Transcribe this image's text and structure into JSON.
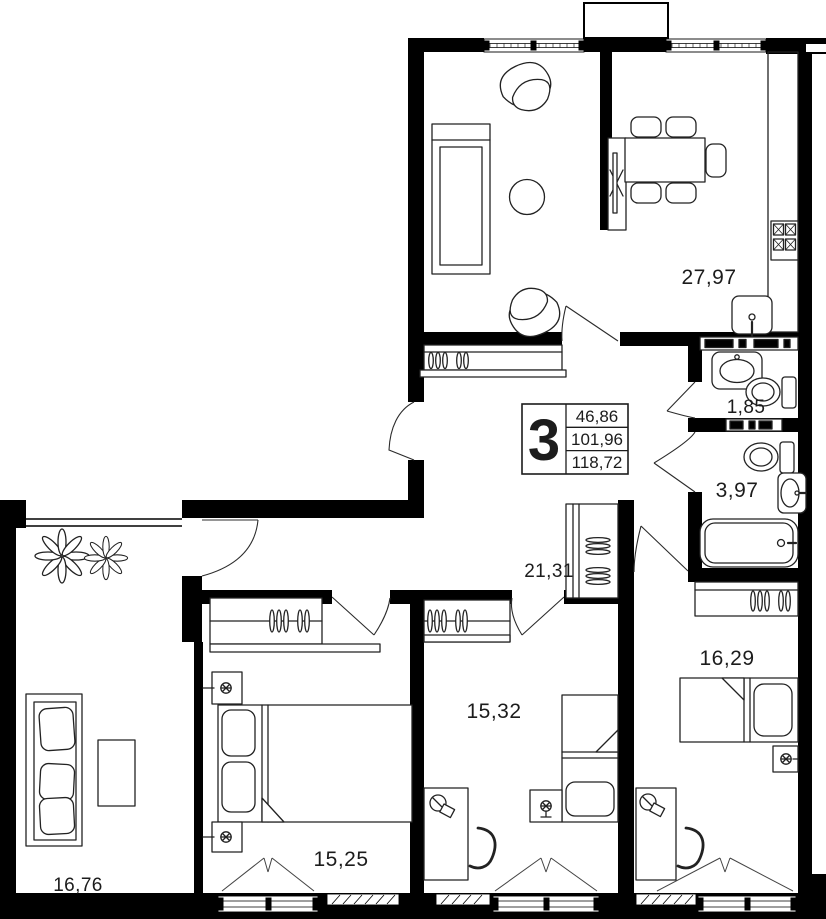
{
  "stamp": {
    "rooms_count": "3",
    "area_living": "46,86",
    "area_main": "101,96",
    "area_total": "118,72"
  },
  "areas": {
    "kitchen_living": "27,97",
    "wc": "1,85",
    "bathroom": "3,97",
    "hallway": "21,31",
    "bedroom_right": "16,29",
    "bedroom_middle": "15,32",
    "bedroom_left": "15,25",
    "terrace": "16,76"
  }
}
